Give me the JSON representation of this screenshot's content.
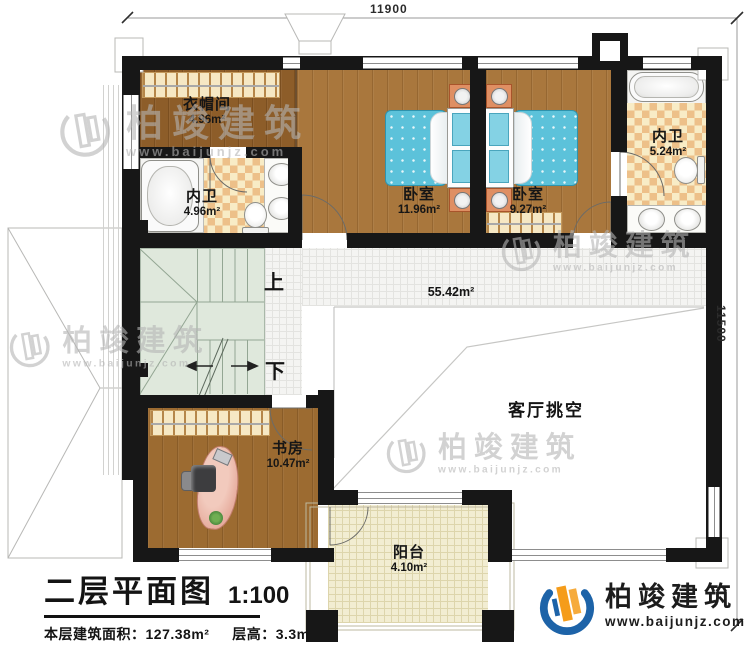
{
  "dimensions": {
    "top": "11900",
    "right": "11500"
  },
  "plan": {
    "rooms": {
      "cloakroom": {
        "name": "衣帽间",
        "area": "4.96m²"
      },
      "bath_left": {
        "name": "内卫",
        "area": "4.96m²"
      },
      "bedroom_left": {
        "name": "卧室",
        "area": "11.96m²"
      },
      "bedroom_right": {
        "name": "卧室",
        "area": "9.27m²"
      },
      "bath_right": {
        "name": "内卫",
        "area": "5.24m²"
      },
      "study": {
        "name": "书房",
        "area": "10.47m²"
      },
      "balcony": {
        "name": "阳台",
        "area": "4.10m²"
      },
      "living_void": {
        "name": "客厅挑空"
      },
      "hall": {
        "area": "55.42m²"
      }
    },
    "stairs": {
      "up": "上",
      "down": "下"
    }
  },
  "title_block": {
    "title": "二层平面图",
    "scale": "1:100",
    "area_label": "本层建筑面积：",
    "area_value": "127.38m²",
    "floor_height_label": "层高：",
    "floor_height_value": "3.3m"
  },
  "watermark": {
    "name": "柏竣建筑",
    "url": "www.baijunjz.com"
  },
  "logo": {
    "name": "柏竣建筑",
    "url": "www.baijunjz.com"
  },
  "colors": {
    "wall": "#171717",
    "logo_blue": "#1d63a8",
    "logo_orange": "#f59c1a",
    "bed": "#5cc2da"
  }
}
